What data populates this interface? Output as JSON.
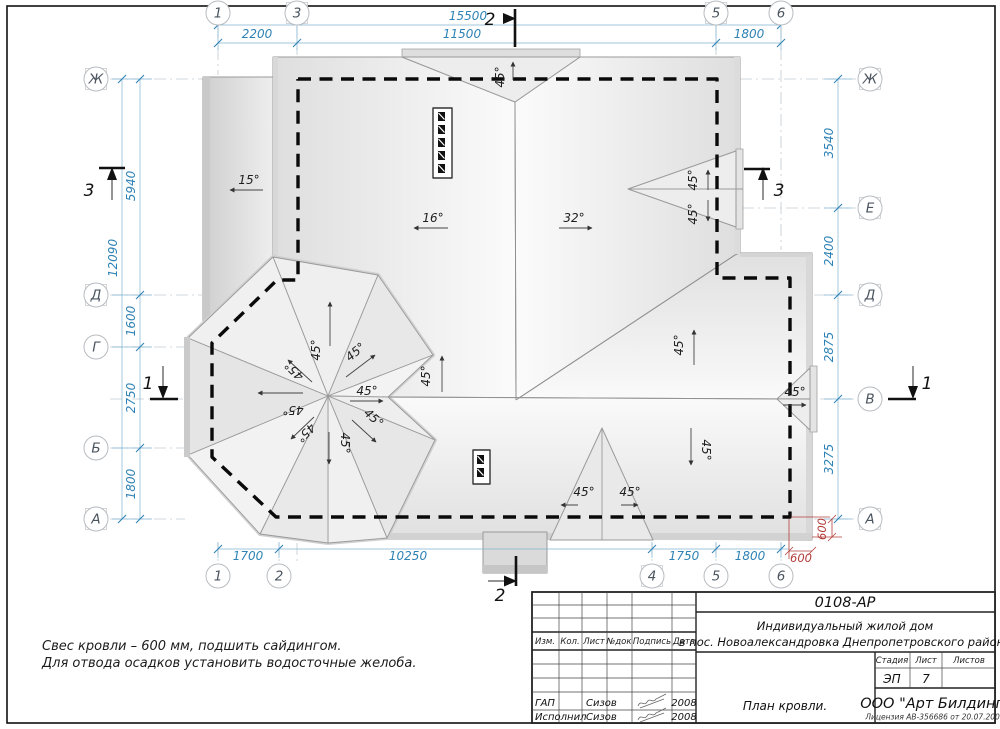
{
  "labels": {
    "deg15": "15°",
    "deg16": "16°",
    "deg32": "32°",
    "deg45": "45°"
  },
  "sections": {
    "s1": "1",
    "s2": "2",
    "s3": "3"
  },
  "axes": {
    "top": [
      "1",
      "3",
      "5",
      "6"
    ],
    "bottom": [
      "1",
      "2",
      "4",
      "5",
      "6"
    ],
    "left": [
      "Ж",
      "Д",
      "Г",
      "Б",
      "А"
    ],
    "right": [
      "Ж",
      "Е",
      "Д",
      "В",
      "А"
    ]
  },
  "dims": {
    "top_overall": "15500",
    "top_left": "2200",
    "top_mid": "11500",
    "top_right": "1800",
    "left_overall": "12090",
    "left_zh_d": "5940",
    "left_d_g": "1600",
    "left_g_b": "2750",
    "left_b_a": "1800",
    "right_zh_e": "3540",
    "right_e_d": "2400",
    "right_d_v": "2875",
    "right_v_a": "3275",
    "bottom_1_2": "1700",
    "bottom_2_4": "10250",
    "bottom_4_5": "1750",
    "bottom_5_6": "1800",
    "overhang": "600"
  },
  "notes": {
    "line1": "Свес кровли – 600 мм, подшить сайдингом.",
    "line2": "Для отвода осадков установить водосточные желоба."
  },
  "titleblock": {
    "doc_number": "0108-АР",
    "project_line1": "Индивидуальный жилой дом",
    "project_line2": "в пос. Новоалександровка Днепропетровского района",
    "drawing_title": "План кровли.",
    "company": "ООО \"Арт Билдинг\"",
    "license": "Лицензия АВ-356686 от 20.07.2007",
    "stage_label": "Стадия",
    "sheet_label": "Лист",
    "sheets_label": "Листов",
    "stage_value": "ЭП",
    "sheet_number": "7",
    "cols": {
      "izm": "Изм.",
      "kol": "Кол.",
      "list": "Лист",
      "ndok": "№док",
      "podpis": "Подпись",
      "data": "Дата"
    },
    "rows": [
      {
        "role": "ГАП",
        "name": "Сизов",
        "year": "2008"
      },
      {
        "role": "Исполнил",
        "name": "Сизов",
        "year": "2008"
      }
    ]
  }
}
